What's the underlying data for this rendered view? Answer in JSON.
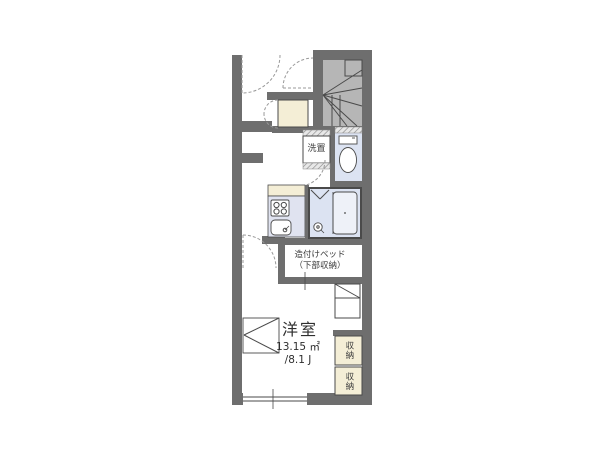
{
  "plan": {
    "washer": {
      "label": "洗置"
    },
    "bed": {
      "line1": "造付けベッド",
      "line2": "（下部収納）"
    },
    "room": {
      "name": "洋室",
      "area_m2": "13.15 ㎡",
      "area_jo": "/8.1 J"
    },
    "storage1": {
      "label": "収納"
    },
    "storage2": {
      "label": "収納"
    }
  },
  "colors": {
    "wall": "#6e6e6e",
    "stairs": "#b6b6b6",
    "water": "#dce3f2",
    "kitchen": "#e0e3f0",
    "cream": "#f4eed6",
    "tub": "#eef1f8",
    "line": "#4a4a4a",
    "dash": "#999999"
  }
}
